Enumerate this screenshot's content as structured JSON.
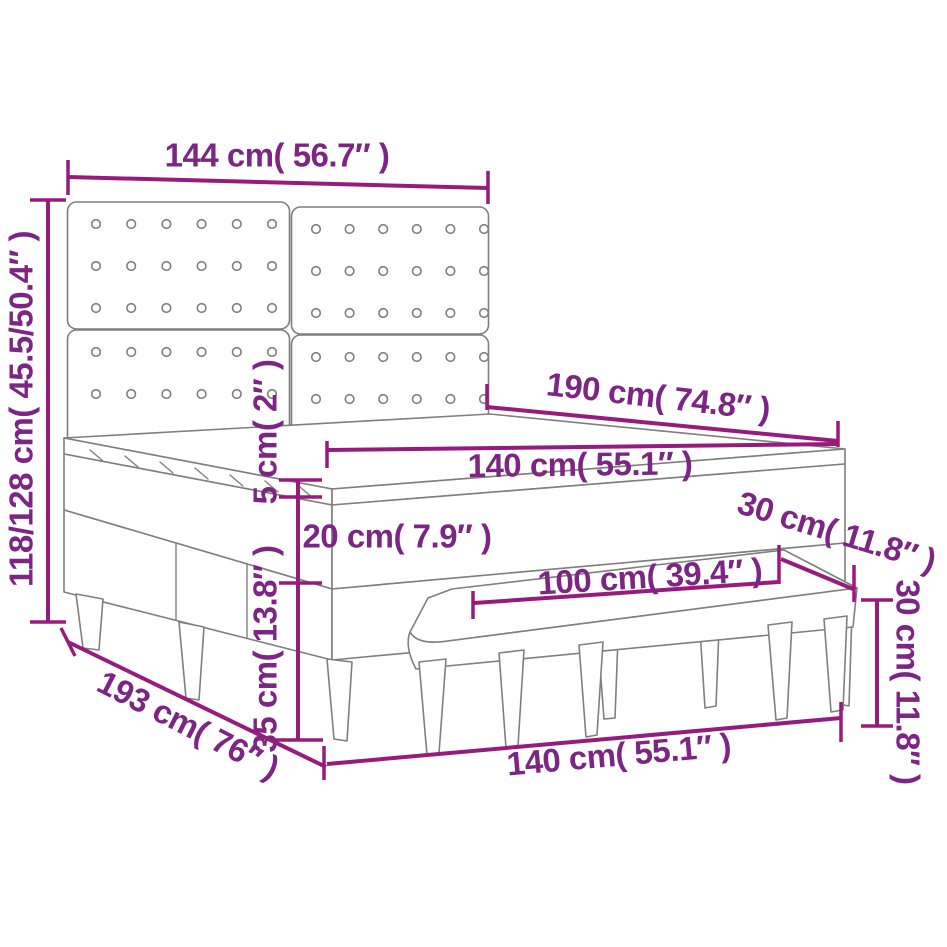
{
  "diagram": {
    "type": "furniture-dimension-diagram",
    "subject": "box spring bed with tufted headboard and bench",
    "accent_color": "#971B7D",
    "text_color": "#7D2583",
    "outline_color": "#7F7F7F",
    "labels": {
      "headboard_width": "144 cm( 56.7″ )",
      "total_height": "118/128 cm( 45.5/50.4″ )",
      "bed_length": "190 cm( 74.8″ )",
      "mattress_width": "140 cm( 55.1″ )",
      "pillow_top_height": "5 cm( 2″ )",
      "mattress_height": "20 cm( 7.9″ )",
      "base_height": "35 cm( 13.8″ )",
      "bench_depth": "30 cm( 11.8″ )",
      "bench_length": "100 cm( 39.4″ )",
      "bench_height": "30 cm( 11.8″ )",
      "frame_length": "193 cm( 76″ )",
      "frame_width": "140 cm( 55.1″ )"
    }
  }
}
